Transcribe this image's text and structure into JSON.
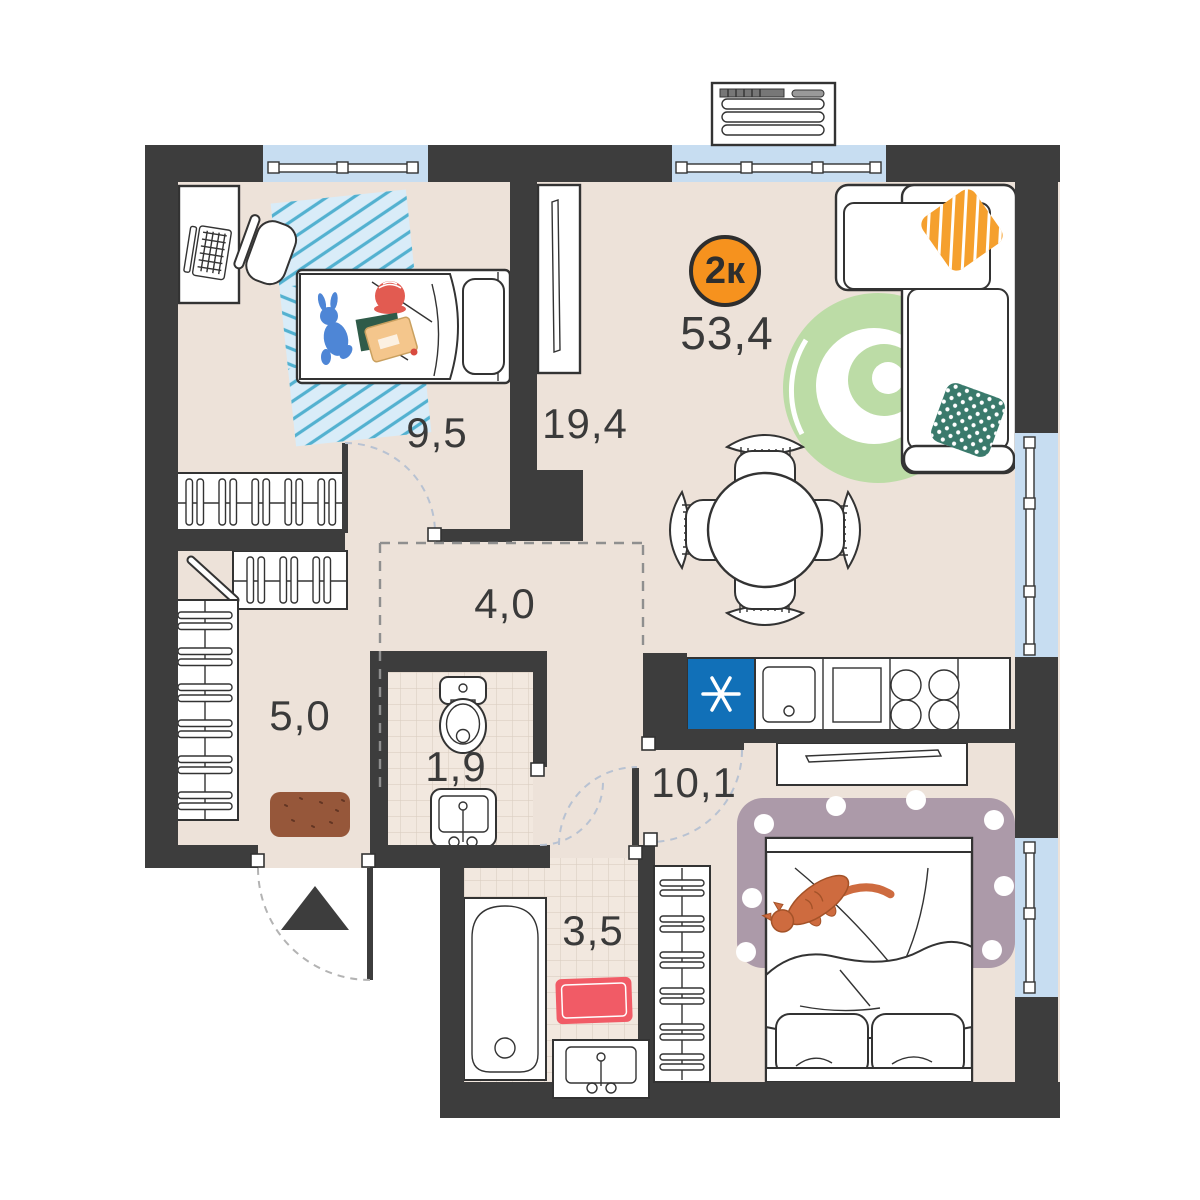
{
  "plan": {
    "badge": {
      "type": "2к",
      "total_area": "53,4"
    },
    "rooms": [
      {
        "id": "kids-bedroom",
        "area": "9,5"
      },
      {
        "id": "living-kitchen",
        "area": "19,4"
      },
      {
        "id": "corridor",
        "area": "4,0"
      },
      {
        "id": "hallway",
        "area": "5,0"
      },
      {
        "id": "wc",
        "area": "1,9"
      },
      {
        "id": "bedroom",
        "area": "10,1"
      },
      {
        "id": "bathroom",
        "area": "3,5"
      }
    ],
    "icons": {
      "fridge": "asterisk-snowflake",
      "entrance": "triangle-up"
    },
    "colors": {
      "wall": "#3D3D3D",
      "floor": "#EDE2D9",
      "tile": "#F2E8DF",
      "window": "#C7DDF1",
      "badge": "#F6921E",
      "fridge": "#1170B8",
      "green": "#BCDCA6",
      "mauve": "#AC9AA9",
      "pink": "#F15B66",
      "orange": "#F5A02E",
      "teal": "#3A7A6C",
      "rugblue": "#D9ECF8",
      "rugstripe": "#53B1D0",
      "cat": "#CE6B3F",
      "doormat": "#96573A"
    }
  }
}
